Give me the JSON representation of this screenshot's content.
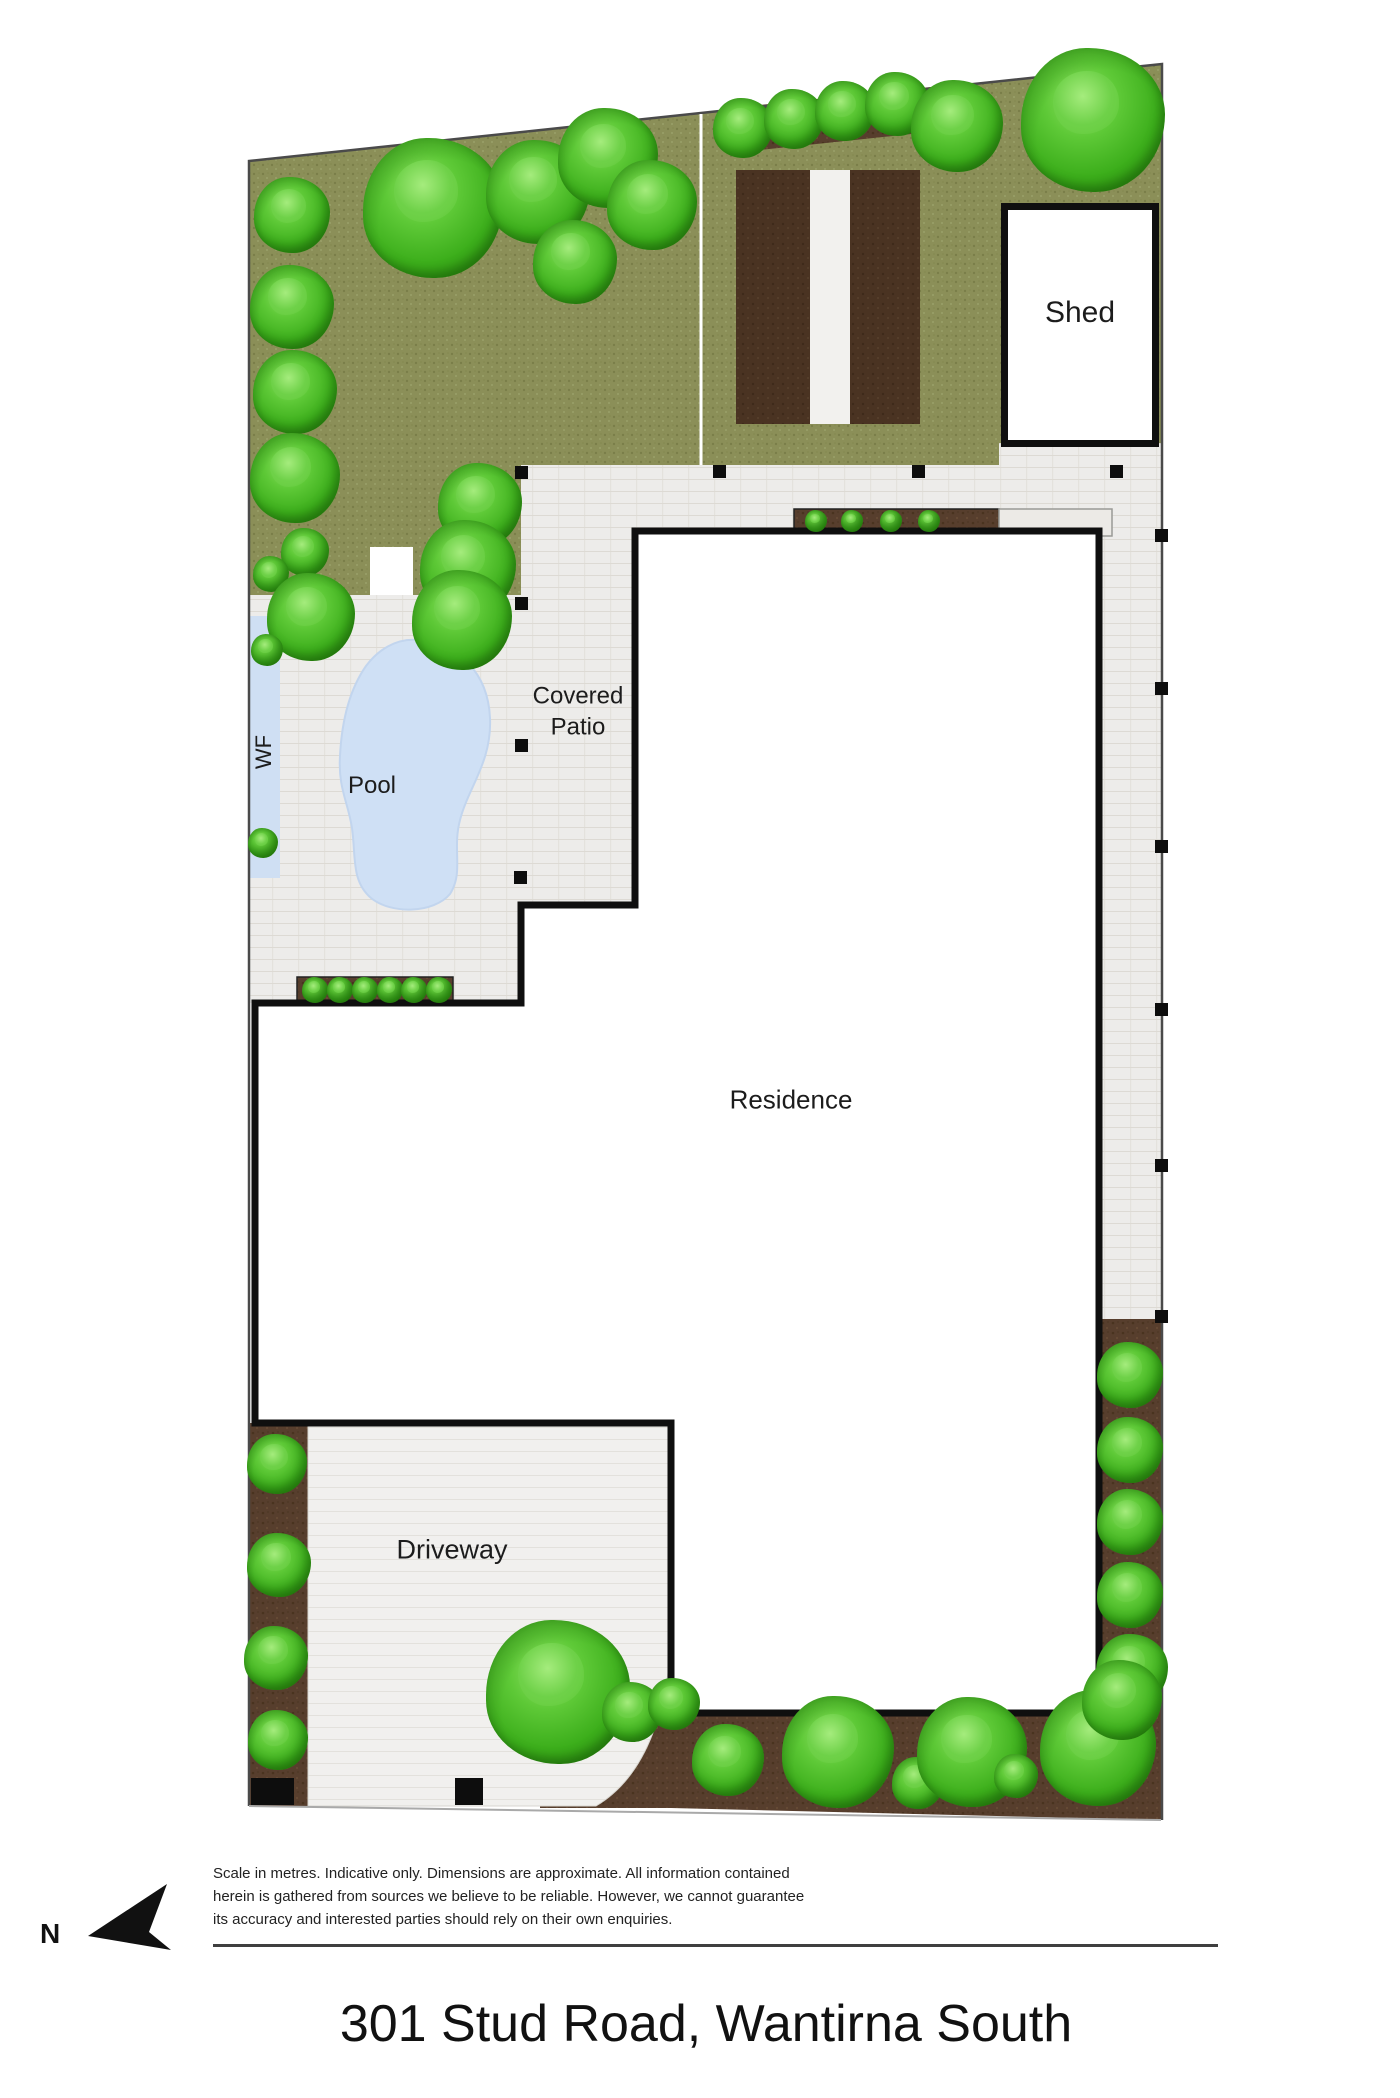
{
  "title": "301 Stud Road, Wantirna South",
  "compass": {
    "label": "N",
    "icon": "north-arrow-icon"
  },
  "disclaimer": {
    "line1": "Scale in metres. Indicative only. Dimensions are approximate. All information contained",
    "line2": "herein is gathered from sources we believe to be reliable. However, we cannot guarantee",
    "line3": "its accuracy and interested parties should rely on their own enquiries."
  },
  "plan": {
    "labels": {
      "shed": "Shed",
      "covered_patio_line1": "Covered",
      "covered_patio_line2": "Patio",
      "pool": "Pool",
      "water_feature": "WF",
      "residence": "Residence",
      "driveway": "Driveway"
    }
  },
  "colors": {
    "grass": "#8b8f58",
    "paving": "#edecea",
    "driveway_paving": "#f1f0ee",
    "garden_bed": "#573e2d",
    "vegetable_bed": "#4a3322",
    "water": "#cfe0f5",
    "outline": "#0f0f0f",
    "tree_green": "#3cae1b"
  }
}
